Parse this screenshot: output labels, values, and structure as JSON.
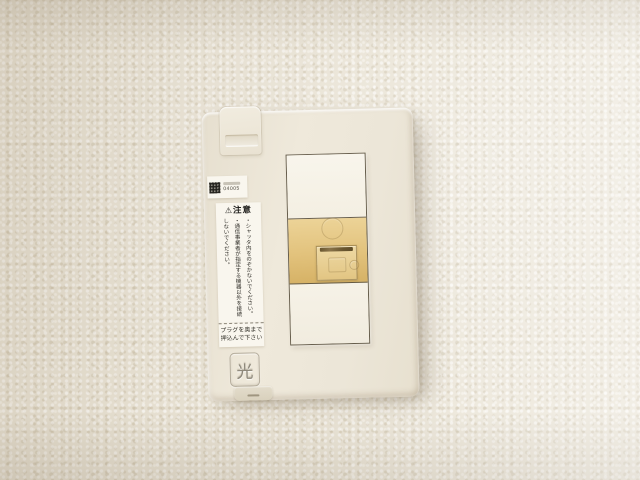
{
  "icons": {
    "warning_triangle": "⚠"
  },
  "plate": {
    "serial_sticker": {
      "code": "04005"
    },
    "warning": {
      "title": "注意",
      "lines": [
        "・シャッタ内をのぞかないでください。",
        "・通信事業者が指定する機器以外を接続しないでください。"
      ]
    },
    "plug_note": {
      "line1": "プラグを奥まで",
      "line2": "押込んで下さい"
    },
    "hikari_label": "光"
  },
  "colors": {
    "wall": "#eae4d6",
    "plate": "#ece6d8",
    "jack_module": "#e2c27c",
    "shutter": "#e6cd94",
    "outline": "#564e3c"
  }
}
